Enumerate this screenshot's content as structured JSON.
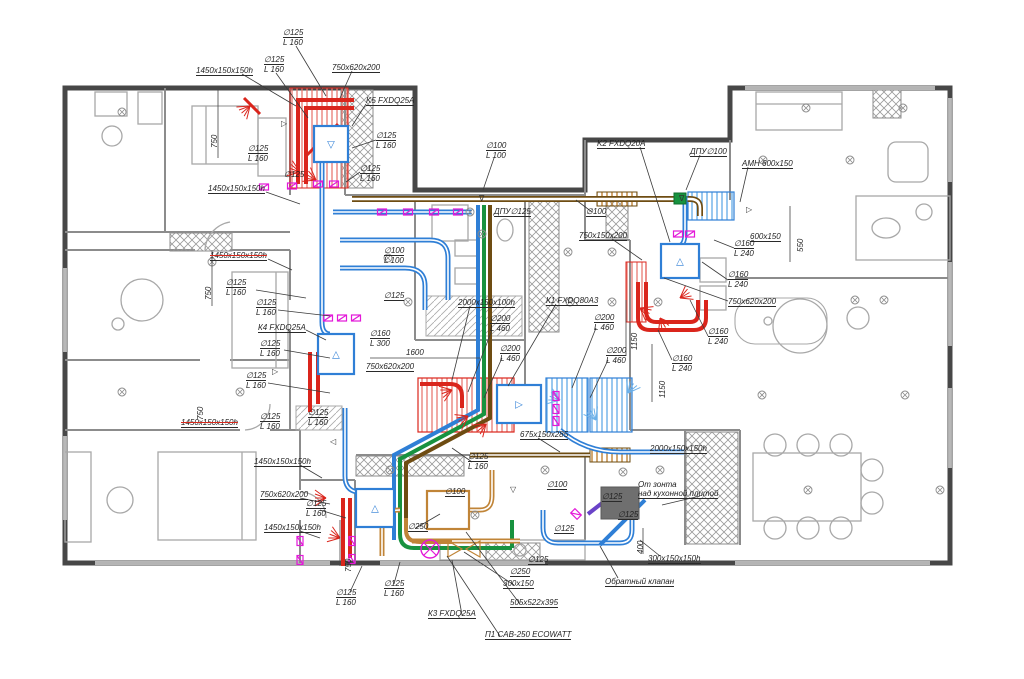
{
  "drawing": {
    "type": "HVAC ventilation floor plan",
    "language": "Russian"
  },
  "palette": {
    "wall": "#474747",
    "thin_wall": "#8c8c8c",
    "furniture": "#a8a8a8",
    "text": "#1f1f1f",
    "duct_blue": "#2f7fd6",
    "duct_light_blue": "#6db1e8",
    "duct_red": "#da251c",
    "duct_green": "#18923f",
    "duct_tan": "#c08437",
    "duct_brown": "#6e4c12",
    "valve_magenta": "#e318d8",
    "duct_violet": "#6a43c8"
  },
  "equipment": [
    {
      "tag": "K5",
      "model": "K5 FXDQ25A"
    },
    {
      "tag": "K4",
      "model": "К4 FXDQ25A"
    },
    {
      "tag": "K2",
      "model": "K2 FXDQ20A"
    },
    {
      "tag": "K1",
      "model": "К1 FXDQ80A3"
    },
    {
      "tag": "K3",
      "model": "К3 FXDQ25A"
    },
    {
      "tag": "П1",
      "model": "П1 CAB-250 ECOWATT"
    },
    {
      "tag": "АМН",
      "model": "АМН 600x150"
    }
  ],
  "units": [
    {
      "name": "unit-k5",
      "x": 314,
      "y": 126,
      "w": 34,
      "h": 36,
      "glyph": "▽",
      "color": "blue"
    },
    {
      "name": "unit-k4",
      "x": 318,
      "y": 334,
      "w": 36,
      "h": 40,
      "glyph": "△",
      "color": "blue"
    },
    {
      "name": "unit-k1",
      "x": 497,
      "y": 385,
      "w": 44,
      "h": 38,
      "glyph": "▷",
      "color": "blue"
    },
    {
      "name": "unit-k2",
      "x": 661,
      "y": 244,
      "w": 38,
      "h": 34,
      "glyph": "△",
      "color": "blue"
    },
    {
      "name": "unit-k3",
      "x": 356,
      "y": 489,
      "w": 38,
      "h": 38,
      "glyph": "△",
      "color": "blue"
    },
    {
      "name": "unit-p1",
      "x": 427,
      "y": 491,
      "w": 42,
      "h": 38,
      "glyph": "",
      "color": "tan"
    }
  ],
  "labels": [
    {
      "t": [
        "∅125",
        "L 160"
      ],
      "x": 283,
      "y": 28,
      "u": 1,
      "ld": [
        296,
        46,
        326,
        96
      ]
    },
    {
      "t": [
        "∅125",
        "L 160"
      ],
      "x": 264,
      "y": 55,
      "u": 1,
      "ld": [
        276,
        73,
        308,
        118
      ]
    },
    {
      "t": [
        "1450x150x150h"
      ],
      "x": 196,
      "y": 66,
      "u": 1,
      "ld": [
        242,
        74,
        296,
        106
      ]
    },
    {
      "t": [
        "750x620x200"
      ],
      "x": 332,
      "y": 63,
      "u": 1,
      "ld": [
        352,
        71,
        340,
        98
      ]
    },
    {
      "t": [
        "K5 FXDQ25A"
      ],
      "x": 366,
      "y": 96,
      "u": 1,
      "ld": [
        366,
        104,
        352,
        126
      ]
    },
    {
      "t": [
        "∅125",
        "L 160"
      ],
      "x": 248,
      "y": 144,
      "u": 1
    },
    {
      "t": [
        "∅125",
        "L 160"
      ],
      "x": 376,
      "y": 131,
      "u": 1,
      "ld": [
        376,
        140,
        352,
        148
      ]
    },
    {
      "t": [
        "∅125",
        "L 160"
      ],
      "x": 360,
      "y": 164,
      "u": 1,
      "ld": [
        360,
        172,
        346,
        182
      ]
    },
    {
      "t": [
        "∅125"
      ],
      "x": 284,
      "y": 170
    },
    {
      "t": [
        "1450x150x150h"
      ],
      "x": 208,
      "y": 184,
      "u": 1,
      "ld": [
        266,
        192,
        300,
        204
      ]
    },
    {
      "t": [
        "750"
      ],
      "x": 210,
      "y": 148,
      "r": 1
    },
    {
      "t": [
        "750"
      ],
      "x": 204,
      "y": 300,
      "r": 1
    },
    {
      "t": [
        "∅100",
        "L 100"
      ],
      "x": 486,
      "y": 141,
      "u": 1,
      "ld": [
        494,
        158,
        483,
        190
      ]
    },
    {
      "t": [
        "ДПУ∅125"
      ],
      "x": 494,
      "y": 207,
      "u": 1
    },
    {
      "t": [
        "∅100"
      ],
      "x": 586,
      "y": 207,
      "u": 1,
      "ld": [
        592,
        212,
        576,
        200
      ]
    },
    {
      "t": [
        "750x150x200"
      ],
      "x": 579,
      "y": 231,
      "u": 1,
      "ld": [
        612,
        239,
        642,
        260
      ]
    },
    {
      "t": [
        "K2 FXDQ20A"
      ],
      "x": 597,
      "y": 139,
      "u": 1,
      "ld": [
        640,
        147,
        670,
        242
      ]
    },
    {
      "t": [
        "ДПУ∅100"
      ],
      "x": 690,
      "y": 147,
      "u": 1,
      "ld": [
        700,
        155,
        686,
        190
      ]
    },
    {
      "t": [
        "АМН 600x150"
      ],
      "x": 742,
      "y": 159,
      "u": 1,
      "ld": [
        748,
        167,
        740,
        202
      ]
    },
    {
      "t": [
        "600x150"
      ],
      "x": 750,
      "y": 232,
      "u": 1
    },
    {
      "t": [
        "550"
      ],
      "x": 796,
      "y": 252,
      "r": 1
    },
    {
      "t": [
        "∅160",
        "L 240"
      ],
      "x": 734,
      "y": 239,
      "u": 1,
      "ld": [
        734,
        248,
        714,
        240
      ]
    },
    {
      "t": [
        "∅160",
        "L 240"
      ],
      "x": 728,
      "y": 270,
      "u": 1,
      "ld": [
        728,
        280,
        702,
        262
      ]
    },
    {
      "t": [
        "750x620x200"
      ],
      "x": 728,
      "y": 297,
      "u": 1,
      "ld": [
        728,
        301,
        664,
        278
      ]
    },
    {
      "t": [
        "∅160",
        "L 240"
      ],
      "x": 708,
      "y": 327,
      "u": 1,
      "ld": [
        708,
        336,
        690,
        300
      ]
    },
    {
      "t": [
        "∅160",
        "L 240"
      ],
      "x": 672,
      "y": 354,
      "u": 1,
      "ld": [
        672,
        360,
        658,
        330
      ]
    },
    {
      "t": [
        "1450x150x150h"
      ],
      "x": 210,
      "y": 251,
      "u": 1,
      "s": 1,
      "ld": [
        268,
        259,
        292,
        270
      ]
    },
    {
      "t": [
        "∅100",
        "L 100"
      ],
      "x": 384,
      "y": 246,
      "u": 1
    },
    {
      "t": [
        "∅125",
        "L 160"
      ],
      "x": 226,
      "y": 278,
      "u": 1,
      "ld": [
        256,
        290,
        306,
        298
      ]
    },
    {
      "t": [
        "∅125",
        "L 160"
      ],
      "x": 256,
      "y": 298,
      "u": 1,
      "ld": [
        278,
        310,
        330,
        316
      ]
    },
    {
      "t": [
        "К4 FXDQ25A"
      ],
      "x": 258,
      "y": 323,
      "u": 1,
      "ld": [
        306,
        330,
        326,
        340
      ]
    },
    {
      "t": [
        "∅125",
        "L 160"
      ],
      "x": 260,
      "y": 339,
      "u": 1,
      "ld": [
        284,
        350,
        330,
        358
      ]
    },
    {
      "t": [
        "∅125"
      ],
      "x": 384,
      "y": 291,
      "u": 1
    },
    {
      "t": [
        "∅160",
        "L 300"
      ],
      "x": 370,
      "y": 329,
      "u": 1
    },
    {
      "t": [
        "750x620x200"
      ],
      "x": 366,
      "y": 362,
      "u": 1
    },
    {
      "t": [
        "1600"
      ],
      "x": 406,
      "y": 348
    },
    {
      "t": [
        "2000x150x100h"
      ],
      "x": 458,
      "y": 298,
      "u": 1,
      "ld": [
        470,
        306,
        452,
        380
      ]
    },
    {
      "t": [
        "К1 FXDQ80A3"
      ],
      "x": 546,
      "y": 296,
      "u": 1,
      "ld": [
        556,
        304,
        508,
        386
      ]
    },
    {
      "t": [
        "∅200",
        "L 460"
      ],
      "x": 490,
      "y": 314,
      "u": 1,
      "ld": [
        492,
        330,
        468,
        392
      ]
    },
    {
      "t": [
        "∅200",
        "L 460"
      ],
      "x": 500,
      "y": 344,
      "u": 1,
      "ld": [
        502,
        358,
        484,
        398
      ]
    },
    {
      "t": [
        "∅200",
        "L 460"
      ],
      "x": 594,
      "y": 313,
      "u": 1,
      "ld": [
        596,
        328,
        572,
        388
      ]
    },
    {
      "t": [
        "∅200",
        "L 460"
      ],
      "x": 606,
      "y": 346,
      "u": 1,
      "ld": [
        608,
        360,
        590,
        398
      ]
    },
    {
      "t": [
        "1150"
      ],
      "x": 630,
      "y": 350,
      "r": 1
    },
    {
      "t": [
        "1150"
      ],
      "x": 658,
      "y": 398,
      "r": 1
    },
    {
      "t": [
        "∅125",
        "L 160"
      ],
      "x": 246,
      "y": 371,
      "u": 1,
      "ld": [
        268,
        383,
        330,
        393
      ]
    },
    {
      "t": [
        "750"
      ],
      "x": 196,
      "y": 420,
      "r": 1
    },
    {
      "t": [
        "1450x150x150h"
      ],
      "x": 181,
      "y": 418,
      "u": 1,
      "s": 1
    },
    {
      "t": [
        "∅125",
        "L 160"
      ],
      "x": 260,
      "y": 412,
      "u": 1
    },
    {
      "t": [
        "∅125",
        "L 160"
      ],
      "x": 308,
      "y": 408,
      "u": 1
    },
    {
      "t": [
        "1450x150x150h"
      ],
      "x": 254,
      "y": 457,
      "u": 1,
      "ld": [
        300,
        465,
        322,
        478
      ]
    },
    {
      "t": [
        "∅125",
        "L 160"
      ],
      "x": 468,
      "y": 452,
      "u": 1,
      "ld": [
        472,
        462,
        452,
        448
      ]
    },
    {
      "t": [
        "675x150x285"
      ],
      "x": 520,
      "y": 430,
      "u": 1,
      "ld": [
        538,
        438,
        560,
        452
      ]
    },
    {
      "t": [
        "2000x150x150h"
      ],
      "x": 650,
      "y": 444,
      "u": 1
    },
    {
      "t": [
        "750x620x200"
      ],
      "x": 260,
      "y": 490,
      "u": 1,
      "ld": [
        300,
        498,
        330,
        504
      ]
    },
    {
      "t": [
        "∅125",
        "L 160"
      ],
      "x": 306,
      "y": 499,
      "u": 1,
      "ld": [
        320,
        510,
        346,
        518
      ]
    },
    {
      "t": [
        "1450x150x150h"
      ],
      "x": 264,
      "y": 523,
      "u": 1,
      "ld": [
        300,
        531,
        320,
        538
      ]
    },
    {
      "t": [
        "750"
      ],
      "x": 344,
      "y": 572,
      "r": 1
    },
    {
      "t": [
        "∅250"
      ],
      "x": 408,
      "y": 522,
      "u": 1,
      "ld": [
        416,
        528,
        440,
        514
      ]
    },
    {
      "t": [
        "∅100"
      ],
      "x": 445,
      "y": 487,
      "u": 1
    },
    {
      "t": [
        "∅100"
      ],
      "x": 547,
      "y": 480,
      "u": 1
    },
    {
      "t": [
        "∅125"
      ],
      "x": 554,
      "y": 524,
      "u": 1
    },
    {
      "t": [
        "∅250"
      ],
      "x": 510,
      "y": 567,
      "u": 1
    },
    {
      "t": [
        "∅125"
      ],
      "x": 528,
      "y": 555,
      "u": 1
    },
    {
      "t": [
        "∅125",
        "L 160"
      ],
      "x": 336,
      "y": 588,
      "u": 1,
      "ld": [
        350,
        592,
        362,
        566
      ]
    },
    {
      "t": [
        "∅125",
        "L 160"
      ],
      "x": 384,
      "y": 579,
      "u": 1,
      "ld": [
        394,
        584,
        400,
        562
      ]
    },
    {
      "t": [
        "К3 FXDQ25A"
      ],
      "x": 428,
      "y": 609,
      "u": 1,
      "ld": [
        462,
        615,
        452,
        560
      ]
    },
    {
      "t": [
        "505x522x395"
      ],
      "x": 510,
      "y": 598,
      "u": 1,
      "ld": [
        520,
        604,
        466,
        532
      ]
    },
    {
      "t": [
        "300x150"
      ],
      "x": 503,
      "y": 579,
      "u": 1,
      "ld": [
        514,
        585,
        464,
        552
      ]
    },
    {
      "t": [
        "П1 CAB-250 ECOWATT"
      ],
      "x": 485,
      "y": 630,
      "u": 1,
      "ld": [
        500,
        636,
        447,
        556
      ]
    },
    {
      "t": [
        "От зонта",
        "над кухонной плитой"
      ],
      "x": 638,
      "y": 480,
      "u": 2,
      "ld": [
        700,
        496,
        662,
        505
      ]
    },
    {
      "t": [
        "∅125"
      ],
      "x": 602,
      "y": 492,
      "u": 1
    },
    {
      "t": [
        "∅125"
      ],
      "x": 618,
      "y": 510,
      "u": 1
    },
    {
      "t": [
        "Обратный клапан"
      ],
      "x": 605,
      "y": 577,
      "u": 1,
      "ld": [
        618,
        578,
        600,
        546
      ]
    },
    {
      "t": [
        "300x150x150h"
      ],
      "x": 648,
      "y": 554,
      "u": 1,
      "ld": [
        660,
        556,
        640,
        540
      ]
    },
    {
      "t": [
        "400"
      ],
      "x": 636,
      "y": 554,
      "r": 1
    }
  ]
}
